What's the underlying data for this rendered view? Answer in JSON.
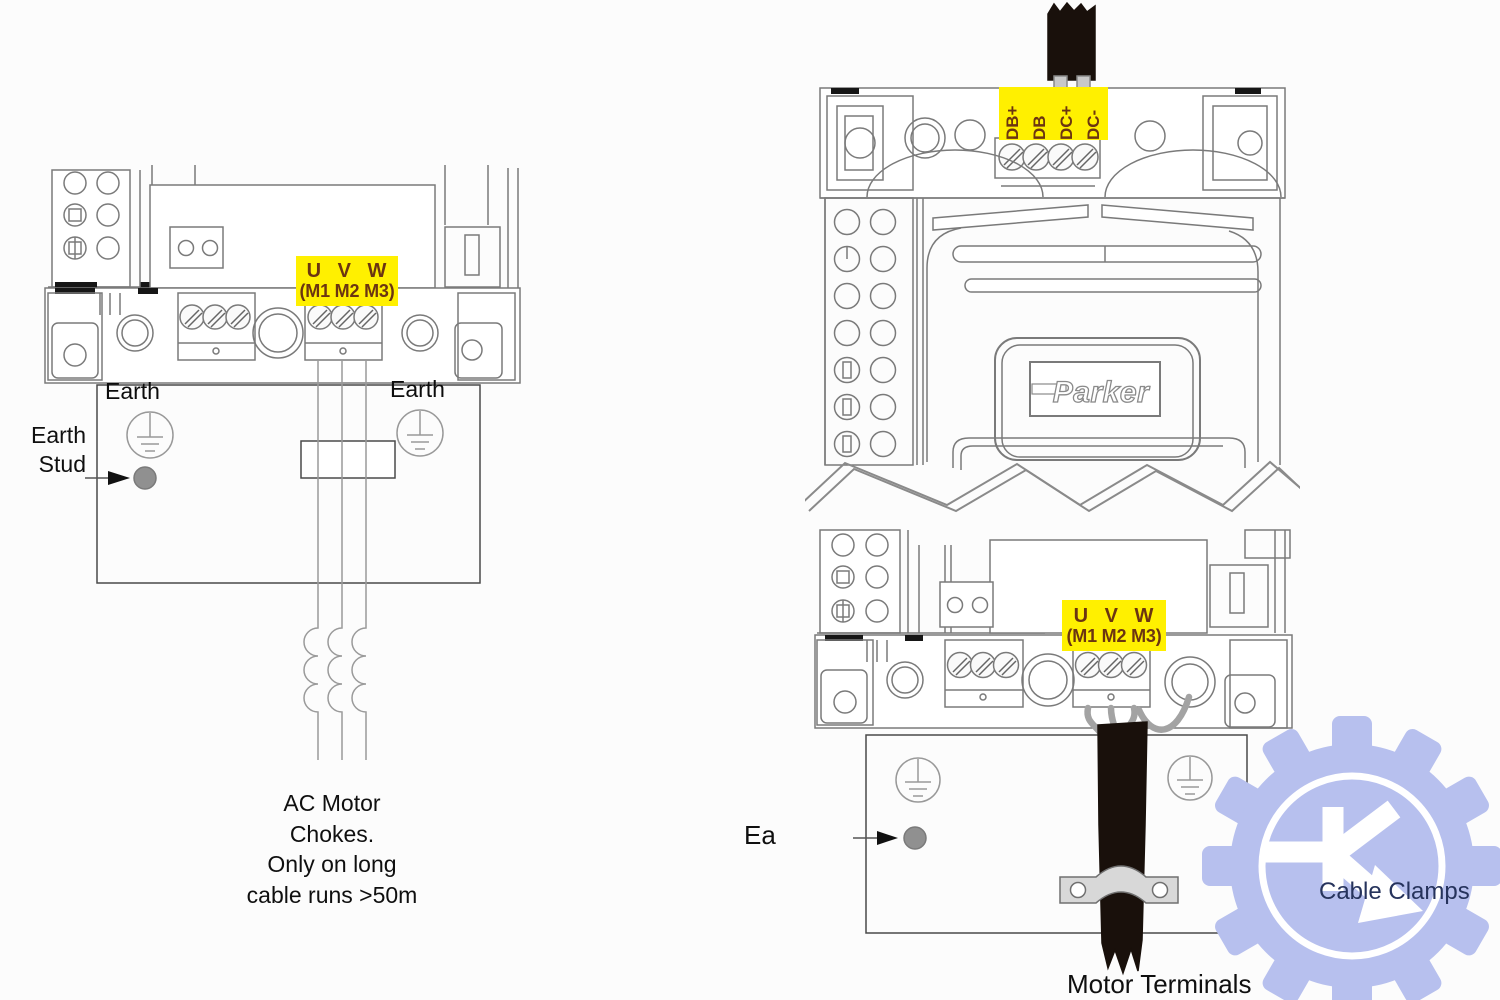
{
  "left_diagram": {
    "motor_terminal_label": {
      "line1": "U V W",
      "line2": "(M1 M2 M3)"
    },
    "earth_label_left": "Earth",
    "earth_label_right": "Earth",
    "earth_stud_label": {
      "line1": "Earth",
      "line2": "Stud"
    },
    "chokes_note": {
      "line1": "AC Motor",
      "line2": "Chokes.",
      "line3": "Only on long",
      "line4": "cable runs >50m"
    }
  },
  "right_diagram_top": {
    "dc_terminal_labels": [
      "DB+",
      "DB",
      "DC+",
      "DC-"
    ],
    "brand_logo": "Parker"
  },
  "right_diagram_bottom": {
    "motor_terminal_label": {
      "line1": "U V W",
      "line2": "(M1 M2 M3)"
    },
    "earth_stud_label": "Ea",
    "cable_clamps_label": "Cable Clamps",
    "motor_terminals_caption": "Motor Terminals"
  },
  "colors": {
    "terminal_label_bg": "#FFF000",
    "terminal_label_text": "#6B3511",
    "line_art": "#777777",
    "cable_black": "#19100B",
    "watermark_gear": "#B7C0EE",
    "cable_clamps_text": "#26335C"
  }
}
